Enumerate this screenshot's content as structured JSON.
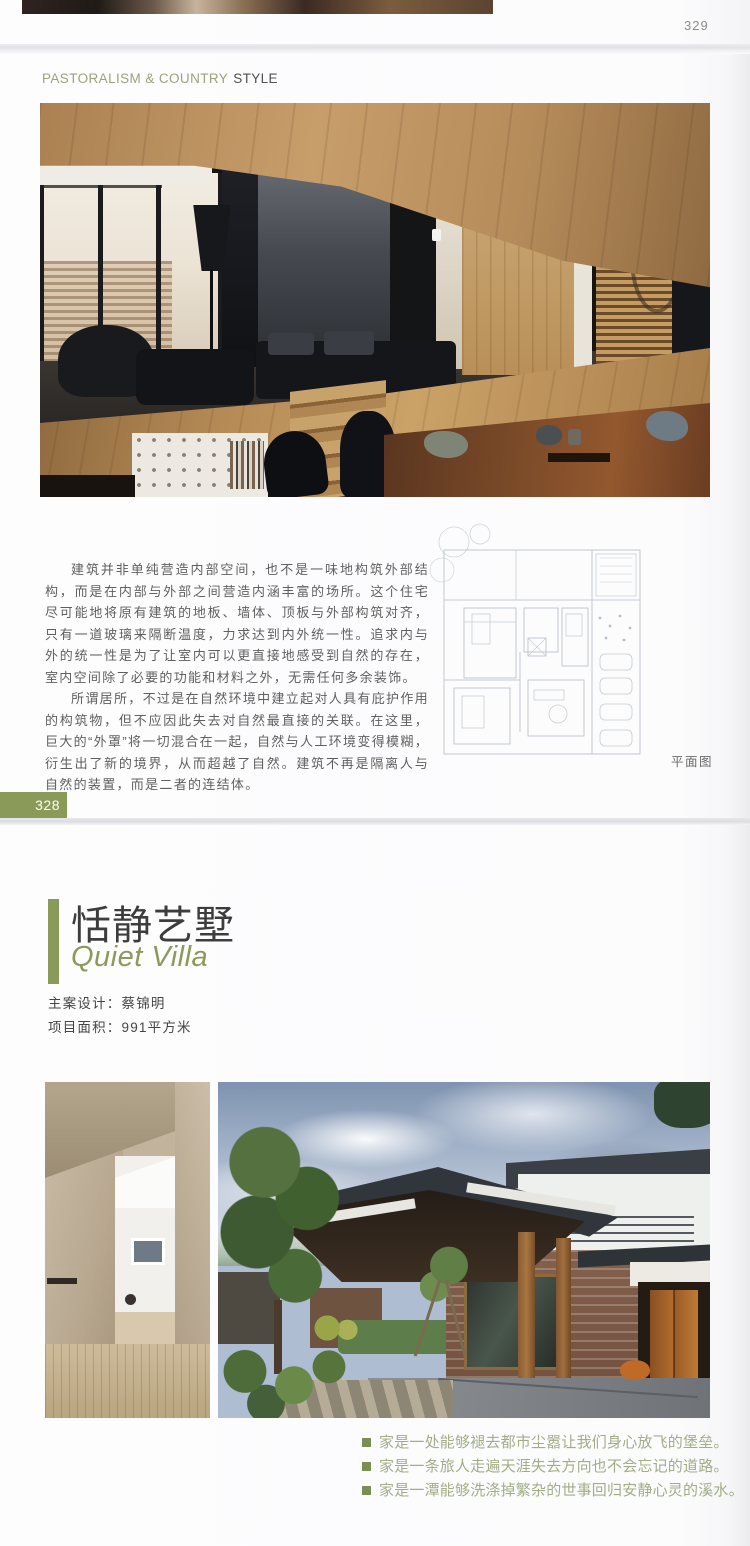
{
  "page_top": {
    "page_number": "329"
  },
  "page_main": {
    "header": {
      "primary": "PASTORALISM & COUNTRY",
      "secondary": "STYLE"
    },
    "paragraph_1": "建筑并非单纯营造内部空间，也不是一味地构筑外部结构，而是在内部与外部之间营造内涵丰富的场所。这个住宅尽可能地将原有建筑的地板、墙体、顶板与外部构筑对齐，只有一道玻璃来隔断温度，力求达到内外统一性。追求内与外的统一性是为了让室内可以更直接地感受到自然的存在，室内空间除了必要的功能和材料之外，无需任何多余装饰。",
    "paragraph_2": "所谓居所，不过是在自然环境中建立起对人具有庇护作用的构筑物，但不应因此失去对自然最直接的关联。在这里，巨大的“外罩”将一切混合在一起，自然与人工环境变得模糊，衍生出了新的境界，从而超越了自然。建筑不再是隔离人与自然的装置，而是二者的连结体。",
    "plan_caption": "平面图",
    "page_number": "328"
  },
  "page_new": {
    "title_cn": "恬静艺墅",
    "title_en": "Quiet Villa",
    "designer_label": "主案设计：",
    "designer_name": "蔡锦明",
    "area_label": "项目面积：",
    "area_value": "991平方米",
    "bullets": [
      "家是一处能够褪去都市尘嚣让我们身心放飞的堡垒。",
      "家是一条旅人走遍天涯失去方向也不会忘记的道路。",
      "家是一潭能够洗涤掉繁杂的世事回归安静心灵的溪水。"
    ]
  },
  "colors": {
    "accent_green": "#8a9a58",
    "header_green": "#9aa37b",
    "bullet_text_green": "#a2ad86"
  }
}
